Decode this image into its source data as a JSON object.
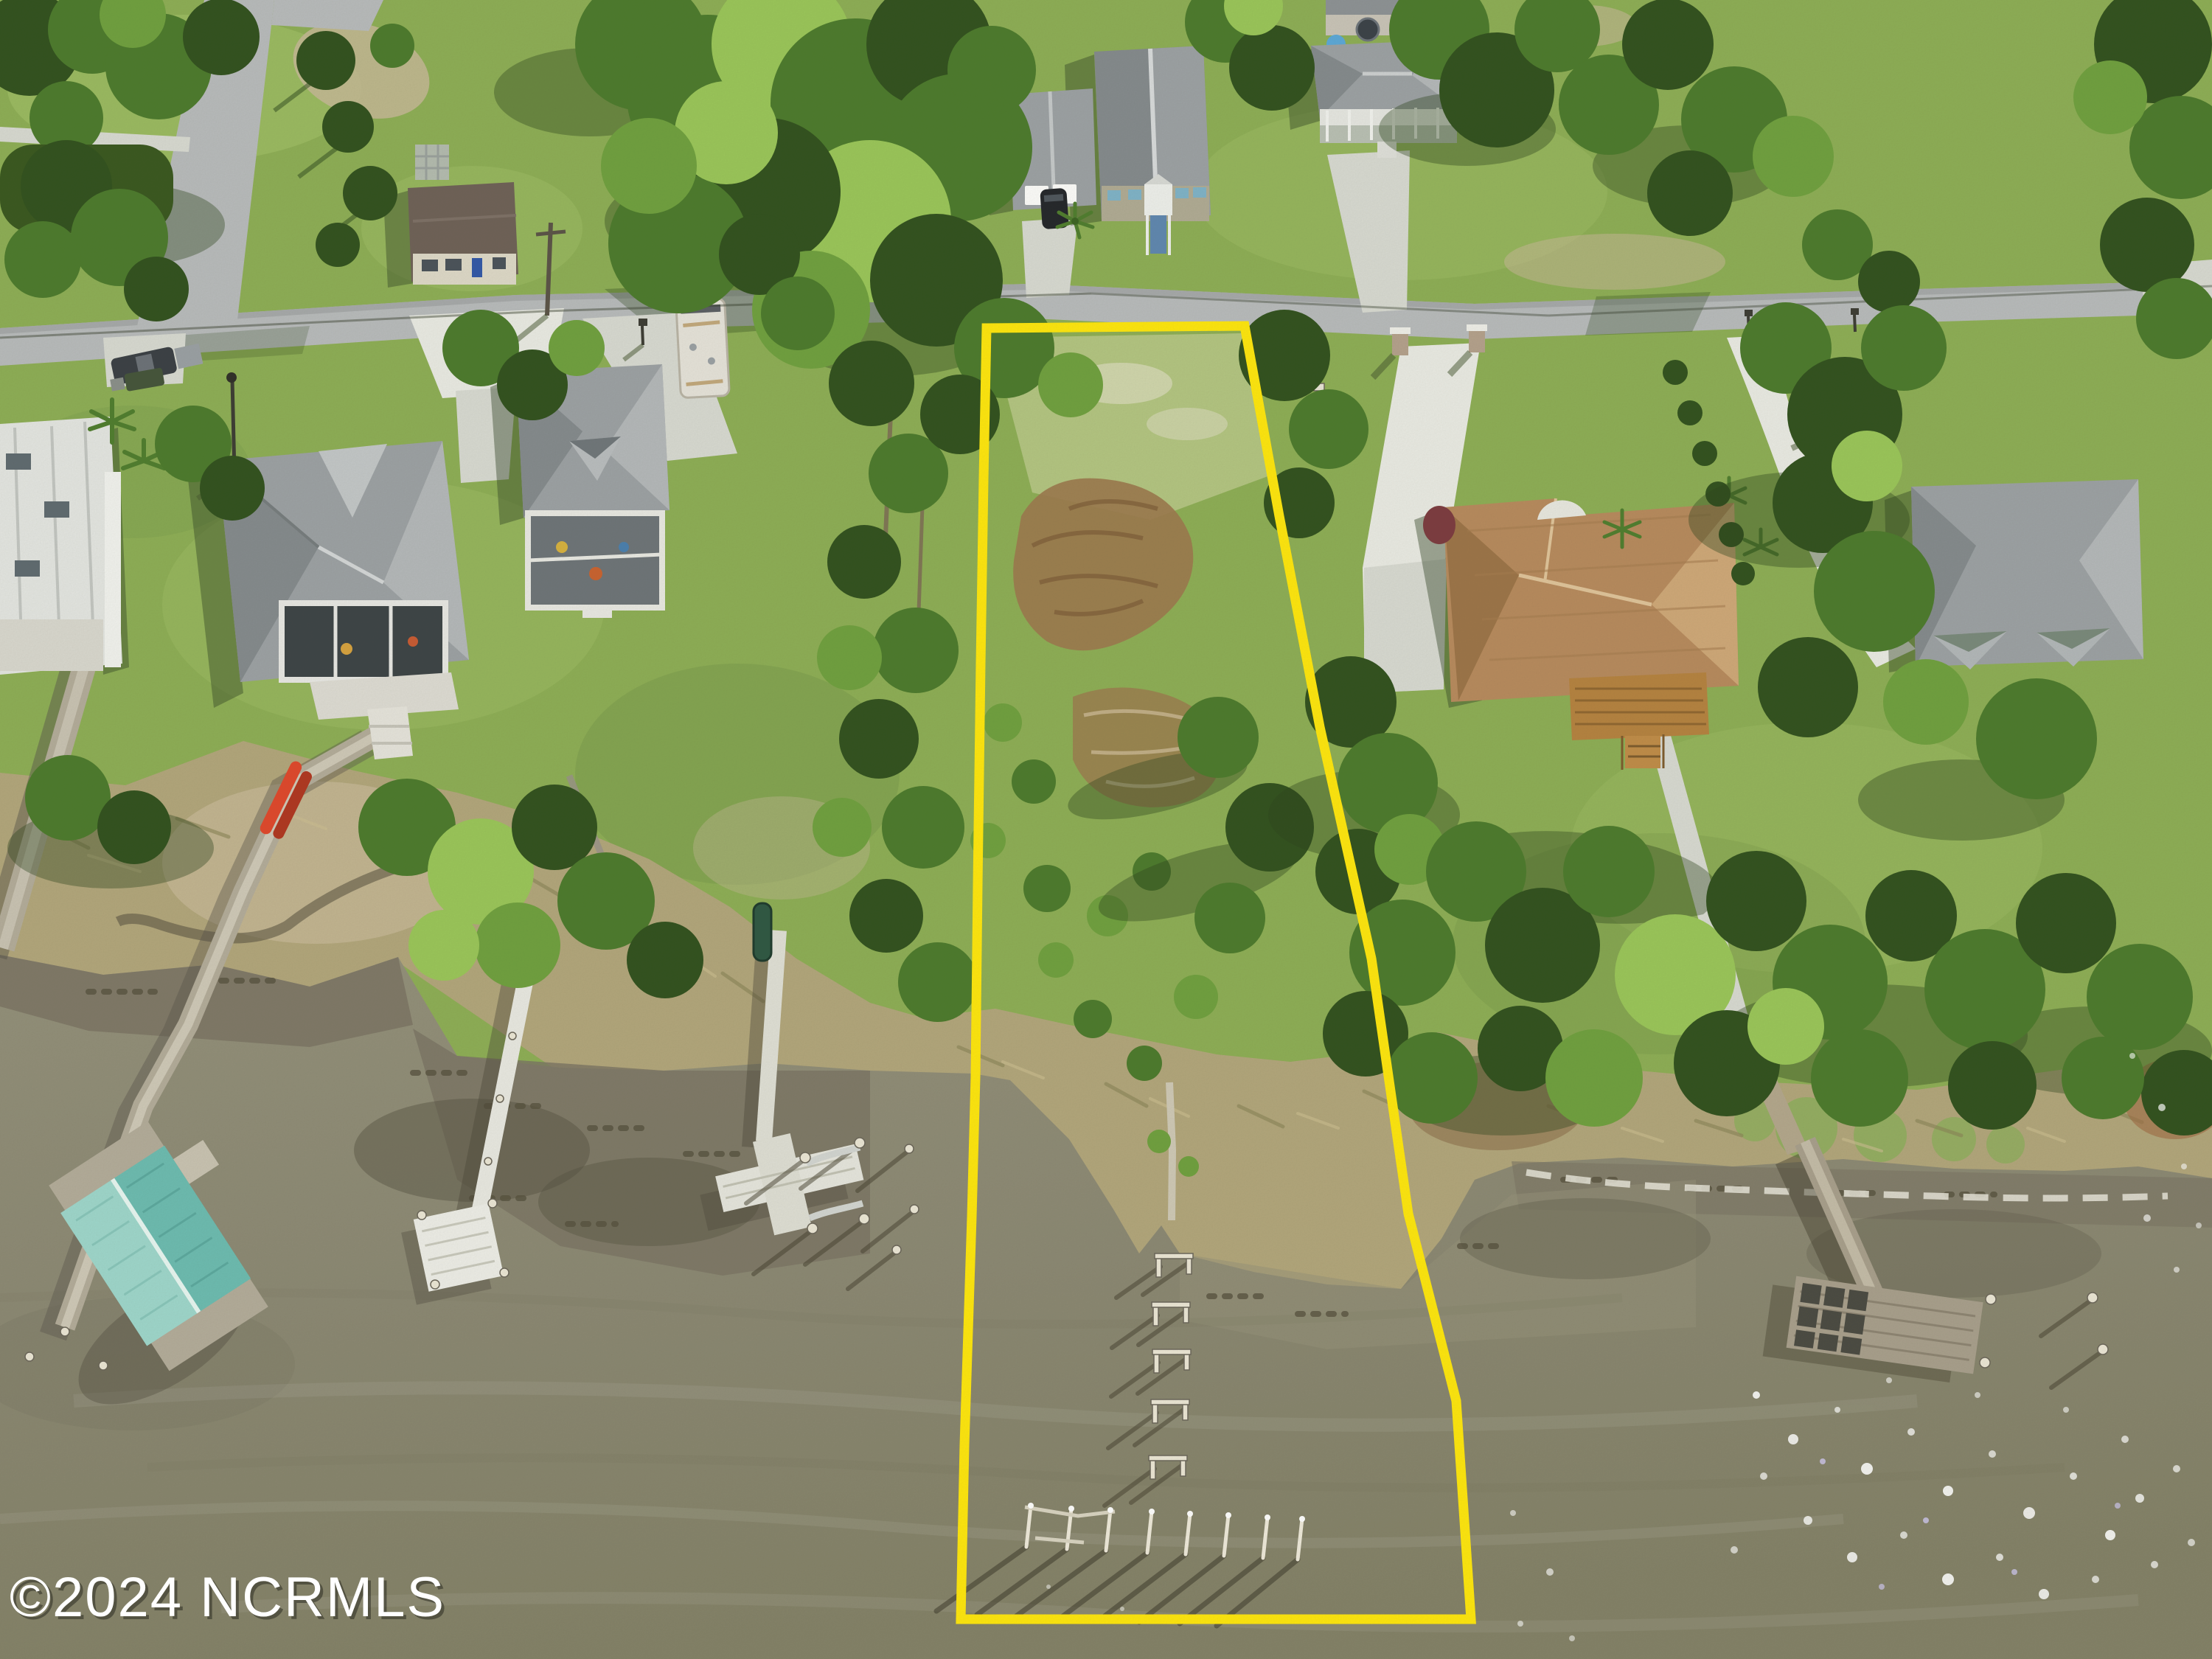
{
  "meta": {
    "type": "aerial-photo",
    "aria_label": "Aerial drone photo of a waterfront neighborhood: houses and lawns along a road, marsh shoreline, docks reaching into olive-brown water, and a vacant lot outlined in yellow with old dock pilings in the water"
  },
  "watermark": {
    "text": "©2024 NCRMLS"
  },
  "lot_outline": {
    "color": "#ffe70d",
    "shape": "tapered parcel from road to water"
  },
  "palette": {
    "water": "#8b8873",
    "waterDeep": "#828066",
    "waterShallow": "#969179",
    "mud": "#7b7464",
    "mudDark": "#5f5a4a",
    "lawn": "#8dae55",
    "lawnLight": "#a5c469",
    "lawnDark": "#6e9044",
    "lawnPale": "#bac989",
    "marsh": "#b2a67b",
    "marshDark": "#8a8457",
    "marshBright": "#8fae5e",
    "sand": "#c6b896",
    "debris": "#9c7a4e",
    "debrisDark": "#7d5c38",
    "road": "#b8bbbc",
    "roadEdge": "#a6a9aa",
    "concrete": "#d8dad2",
    "concreteBright": "#eaebe4",
    "treeDark": "#31511e",
    "tree": "#4c7a2c",
    "treeLight": "#6fa03e",
    "treeBright": "#9ac659",
    "shadow": "#2c451c",
    "roofGray": "#9ca1a4",
    "roofGrayDark": "#848a8d",
    "roofGrayLight": "#b4b8ba",
    "roofBrown": "#6e6157",
    "roofTan": "#b78a5d",
    "roofTanLight": "#cfa878",
    "roofTanDark": "#9c7448",
    "white": "#edeee9",
    "whiteDim": "#d9dad2",
    "boathouse": "#9ed7cc",
    "boathouseDark": "#6cbcb1",
    "deckWood": "#b5823f",
    "dockOld": "#aaa18e",
    "dockOldDark": "#6e685c",
    "yellow": "#ffe70d",
    "kayak": "#e0472b",
    "canoe": "#2e5743",
    "pool": "#5ba8d8"
  }
}
